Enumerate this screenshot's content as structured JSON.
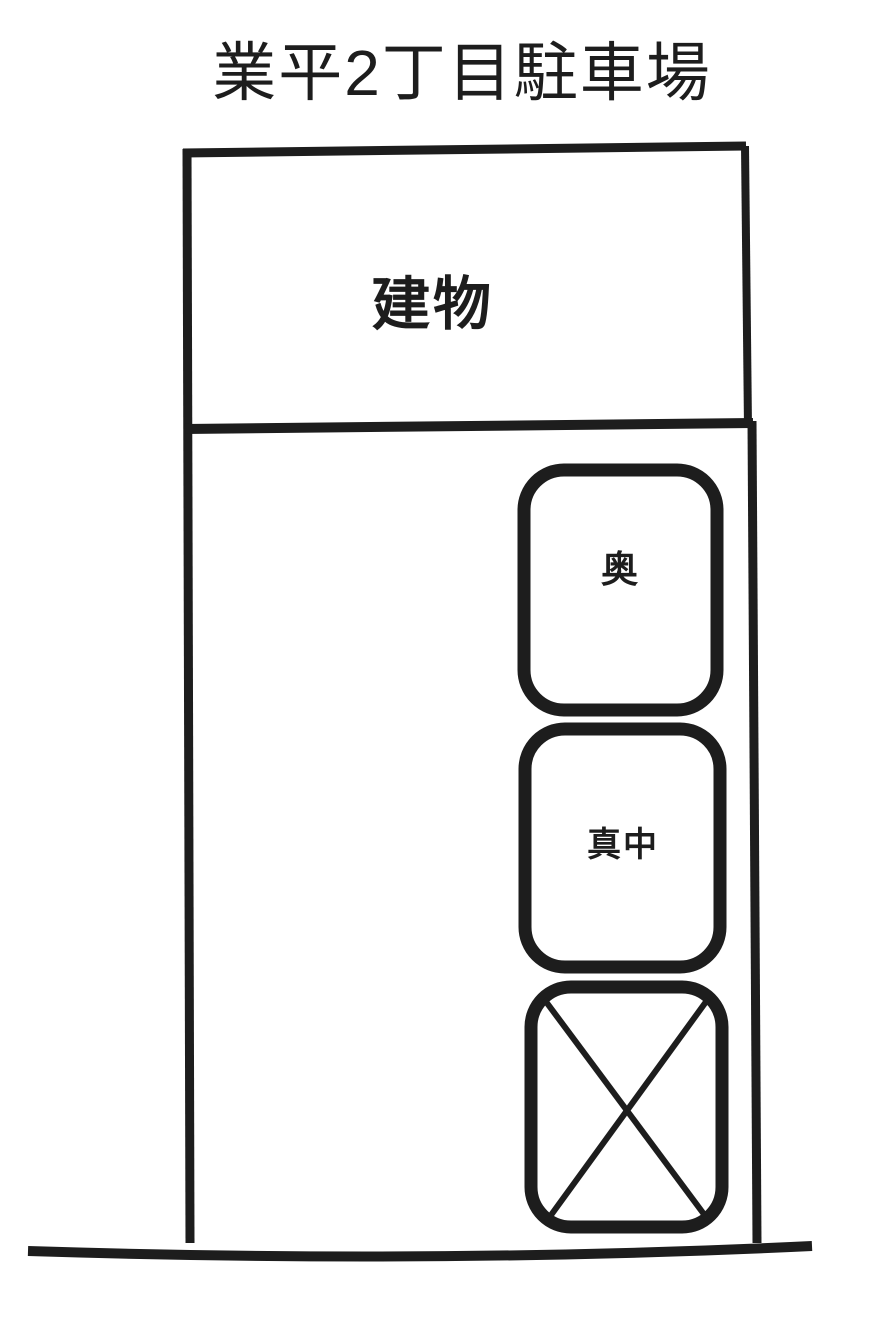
{
  "title": "業平2丁目駐車場",
  "building": {
    "label": "建物"
  },
  "parking_spots": [
    {
      "id": "oku",
      "label": "奥",
      "status": "available"
    },
    {
      "id": "mannaka",
      "label": "真中",
      "status": "available"
    },
    {
      "id": "temae",
      "label": "",
      "status": "crossed-out",
      "marker": "X"
    }
  ],
  "colors": {
    "ink": "#1d1d1d",
    "paper": "#ffffff"
  }
}
